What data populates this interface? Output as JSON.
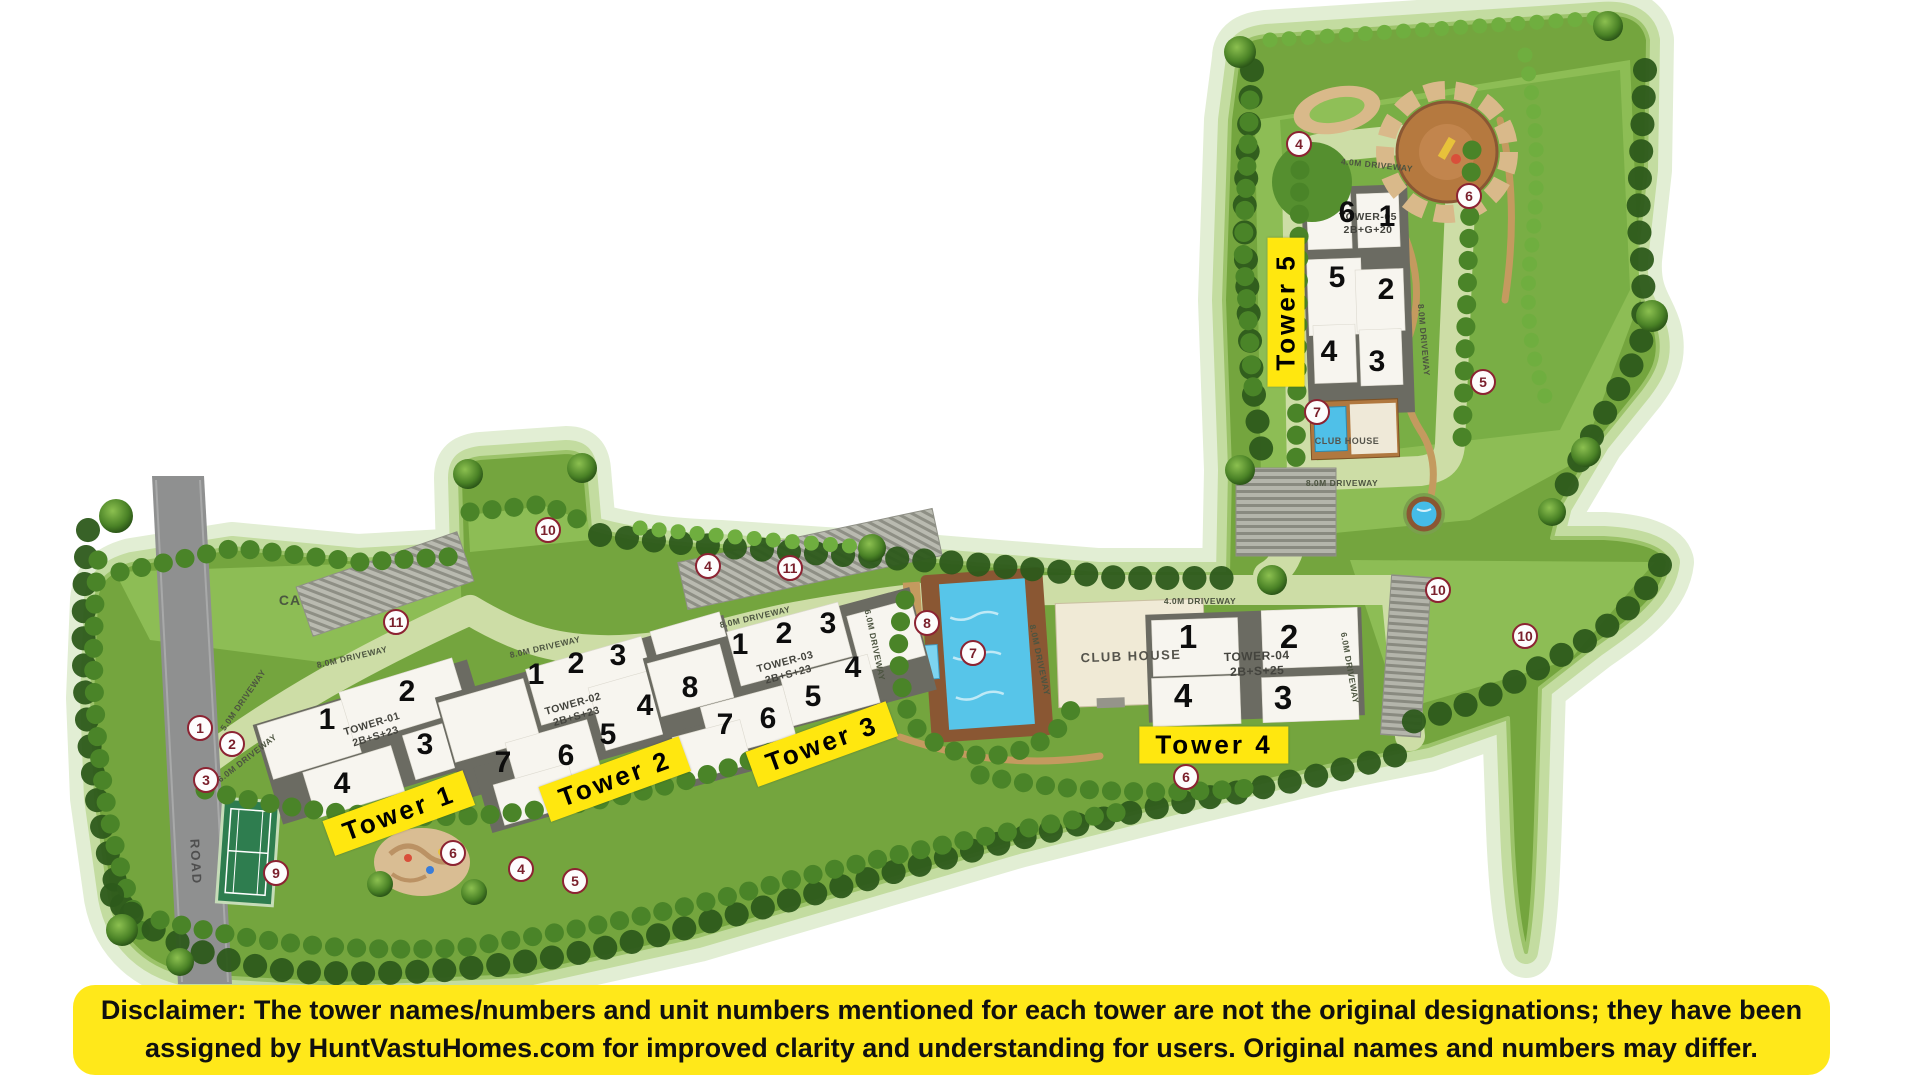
{
  "site_plan": {
    "towers": [
      {
        "label": "Tower 1",
        "plate": "TOWER-01",
        "floors": "2B+S+23",
        "units": [
          "1",
          "2",
          "3",
          "4"
        ]
      },
      {
        "label": "Tower 2",
        "plate": "TOWER-02",
        "floors": "2B+S+23",
        "units": [
          "1",
          "2",
          "3",
          "4",
          "5",
          "6",
          "7",
          "8"
        ]
      },
      {
        "label": "Tower 3",
        "plate": "TOWER-03",
        "floors": "2B+S+23",
        "units": [
          "1",
          "2",
          "3",
          "4",
          "5",
          "6",
          "7"
        ]
      },
      {
        "label": "Tower 4",
        "plate": "TOWER-04",
        "floors": "2B+S+25",
        "units": [
          "1",
          "2",
          "3",
          "4"
        ]
      },
      {
        "label": "Tower 5",
        "plate": "TOWER-05",
        "floors": "2B+G+20",
        "units": [
          "1",
          "2",
          "3",
          "4",
          "5",
          "6"
        ]
      }
    ],
    "club_house_main": "CLUB HOUSE",
    "club_house_t5": "CLUB HOUSE",
    "road": "ROAD",
    "ca": "CA",
    "driveway_labels": [
      {
        "text": "5.0M DRIVEWAY"
      },
      {
        "text": "6.0M DRIVEWAY"
      },
      {
        "text": "8.0M DRIVEWAY"
      },
      {
        "text": "8.0M DRIVEWAY"
      },
      {
        "text": "8.0M DRIVEWAY"
      },
      {
        "text": "6.0M DRIVEWAY"
      },
      {
        "text": "8.0M DRIVEWAY"
      },
      {
        "text": "4.0M DRIVEWAY"
      },
      {
        "text": "6.0M DRIVEWAY"
      },
      {
        "text": "4.0M DRIVEWAY"
      },
      {
        "text": "8.0M DRIVEWAY"
      },
      {
        "text": "8.0M DRIVEWAY"
      }
    ],
    "markers": [
      {
        "n": "1"
      },
      {
        "n": "2"
      },
      {
        "n": "3"
      },
      {
        "n": "9"
      },
      {
        "n": "11"
      },
      {
        "n": "10"
      },
      {
        "n": "4"
      },
      {
        "n": "11"
      },
      {
        "n": "6"
      },
      {
        "n": "4"
      },
      {
        "n": "5"
      },
      {
        "n": "8"
      },
      {
        "n": "7"
      },
      {
        "n": "6"
      },
      {
        "n": "4"
      },
      {
        "n": "6"
      },
      {
        "n": "5"
      },
      {
        "n": "7"
      },
      {
        "n": "10"
      },
      {
        "n": "10"
      }
    ]
  },
  "disclaimer": {
    "line1": "Disclaimer: The tower names/numbers and unit numbers mentioned for each tower are not the original designations; they have been",
    "line2": "assigned by HuntVastuHomes.com for improved clarity and understanding for users. Original names and numbers may differ."
  },
  "colors": {
    "highlight_yellow": "#ffe70f",
    "marker_maroon": "#7a1f2b",
    "pool_blue": "#57c5e9",
    "lawn_green": "#74a53e"
  }
}
